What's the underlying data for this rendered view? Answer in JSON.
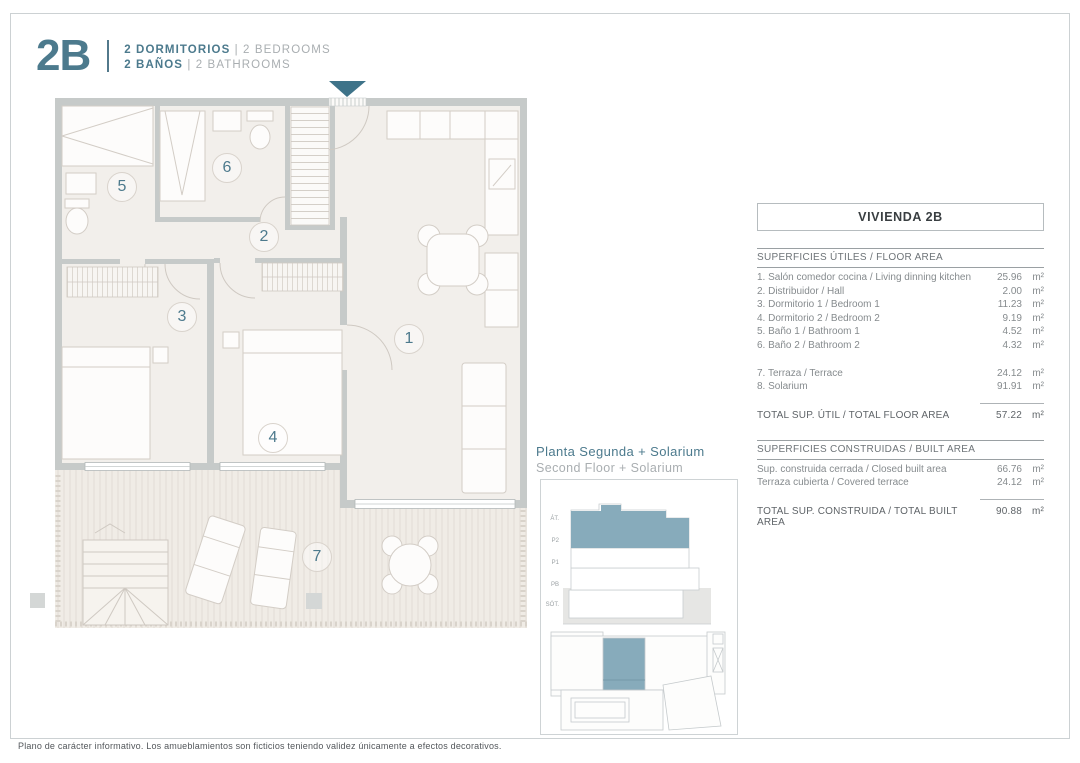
{
  "header": {
    "unit": "2B",
    "line1": {
      "primary": "2 DORMITORIOS",
      "sep": "|",
      "secondary": "2 BEDROOMS"
    },
    "line2": {
      "primary": "2 BAÑOS",
      "sep": "|",
      "secondary": "2 BATHROOMS"
    }
  },
  "plan": {
    "markers": [
      "1",
      "2",
      "3",
      "4",
      "5",
      "6",
      "7"
    ]
  },
  "caption": {
    "title": "Planta Segunda + Solarium",
    "subtitle": "Second Floor + Solarium"
  },
  "key_plan": {
    "floor_labels": [
      "ÁT.",
      "P2",
      "P1",
      "PB",
      "SÓT."
    ],
    "highlight_color": "#87abbb"
  },
  "panel": {
    "title": "VIVIENDA 2B",
    "floor_area": {
      "heading": "SUPERFICIES ÚTILES / FLOOR AREA",
      "rows": [
        {
          "label": "1. Salón comedor cocina / Living dinning kitchen",
          "value": "25.96",
          "unit": "m²"
        },
        {
          "label": "2. Distribuidor / Hall",
          "value": "2.00",
          "unit": "m²"
        },
        {
          "label": "3. Dormitorio 1 / Bedroom 1",
          "value": "11.23",
          "unit": "m²"
        },
        {
          "label": "4. Dormitorio 2 / Bedroom 2",
          "value": "9.19",
          "unit": "m²"
        },
        {
          "label": "5. Baño 1 / Bathroom 1",
          "value": "4.52",
          "unit": "m²"
        },
        {
          "label": "6. Baño 2 / Bathroom 2",
          "value": "4.32",
          "unit": "m²"
        },
        {
          "label": "7. Terraza / Terrace",
          "value": "24.12",
          "unit": "m²"
        },
        {
          "label": "8. Solarium",
          "value": "91.91",
          "unit": "m²"
        }
      ],
      "total": {
        "label": "TOTAL SUP. ÚTIL / TOTAL FLOOR AREA",
        "value": "57.22",
        "unit": "m²"
      }
    },
    "built_area": {
      "heading": "SUPERFICIES CONSTRUIDAS / BUILT AREA",
      "rows": [
        {
          "label": "Sup. construida cerrada / Closed built area",
          "value": "66.76",
          "unit": "m²"
        },
        {
          "label": "Terraza cubierta / Covered terrace",
          "value": "24.12",
          "unit": "m²"
        }
      ],
      "total": {
        "label": "TOTAL SUP. CONSTRUIDA /  TOTAL BUILT AREA",
        "value": "90.88",
        "unit": "m²"
      }
    }
  },
  "footer": {
    "disclaimer": "Plano de carácter informativo. Los amueblamientos son ficticios teniendo validez únicamente a efectos decorativos."
  },
  "colors": {
    "accent_teal": "#4c7a8d",
    "key_highlight": "#87abbb",
    "wall_gray": "#c6cac9",
    "floor_beige": "#f2efeb"
  }
}
